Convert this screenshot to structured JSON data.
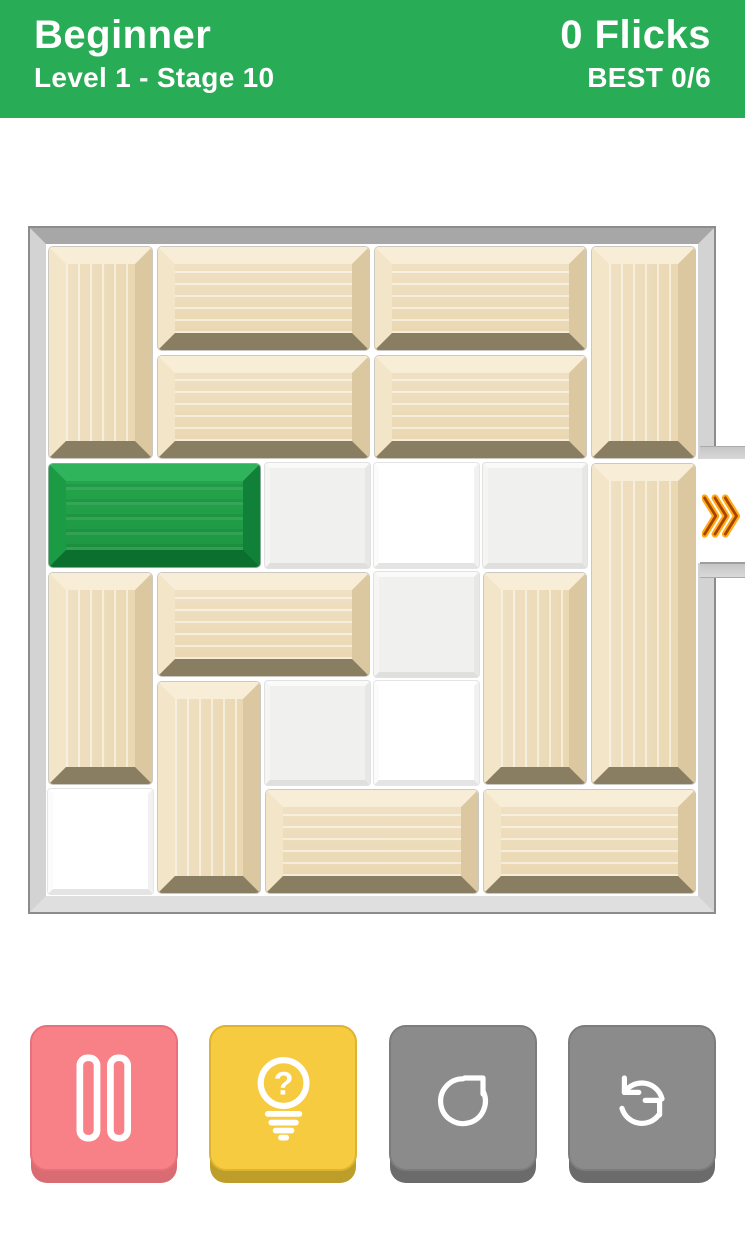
{
  "header": {
    "difficulty": "Beginner",
    "stage": "Level 1 - Stage 10",
    "flicks": "0 Flicks",
    "best": "BEST 0/6",
    "bg": "#28AC55",
    "text_color": "#FFFFFF"
  },
  "board": {
    "rows": 6,
    "cols": 6,
    "frame_color": "#C9C9C9",
    "exit": {
      "side": "right",
      "row": 2,
      "icon": "triple-chevron-right",
      "arrow_glow": "#FFAA16",
      "arrow_core": "#A84300"
    },
    "blocks": [
      {
        "id": "wood-v1",
        "type": "wood",
        "row": 0,
        "col": 0,
        "w": 1,
        "h": 2
      },
      {
        "id": "wood-h1",
        "type": "wood",
        "row": 0,
        "col": 1,
        "w": 2,
        "h": 1
      },
      {
        "id": "wood-h2",
        "type": "wood",
        "row": 0,
        "col": 3,
        "w": 2,
        "h": 1
      },
      {
        "id": "wood-v2",
        "type": "wood",
        "row": 0,
        "col": 5,
        "w": 1,
        "h": 2
      },
      {
        "id": "wood-h3",
        "type": "wood",
        "row": 1,
        "col": 1,
        "w": 2,
        "h": 1
      },
      {
        "id": "wood-h4",
        "type": "wood",
        "row": 1,
        "col": 3,
        "w": 2,
        "h": 1
      },
      {
        "id": "hero",
        "type": "green",
        "row": 2,
        "col": 0,
        "w": 2,
        "h": 1
      },
      {
        "id": "wood-v3",
        "type": "wood",
        "row": 2,
        "col": 5,
        "w": 1,
        "h": 3
      },
      {
        "id": "wood-v4",
        "type": "wood",
        "row": 3,
        "col": 0,
        "w": 1,
        "h": 2
      },
      {
        "id": "wood-h5",
        "type": "wood",
        "row": 3,
        "col": 1,
        "w": 2,
        "h": 1
      },
      {
        "id": "wood-v5",
        "type": "wood",
        "row": 3,
        "col": 4,
        "w": 1,
        "h": 2
      },
      {
        "id": "wood-v6",
        "type": "wood",
        "row": 4,
        "col": 1,
        "w": 1,
        "h": 2
      },
      {
        "id": "wood-h6",
        "type": "wood",
        "row": 5,
        "col": 2,
        "w": 2,
        "h": 1
      },
      {
        "id": "wood-h7",
        "type": "wood",
        "row": 5,
        "col": 4,
        "w": 2,
        "h": 1
      }
    ],
    "empty_cells": [
      {
        "row": 2,
        "col": 2,
        "shade": "gray"
      },
      {
        "row": 2,
        "col": 3,
        "shade": "white"
      },
      {
        "row": 2,
        "col": 4,
        "shade": "gray"
      },
      {
        "row": 3,
        "col": 3,
        "shade": "gray"
      },
      {
        "row": 4,
        "col": 2,
        "shade": "gray"
      },
      {
        "row": 4,
        "col": 3,
        "shade": "white"
      },
      {
        "row": 5,
        "col": 0,
        "shade": "white"
      }
    ],
    "palette": {
      "wood_face": "#ECDAB6",
      "wood_highlight": "#F8EED8",
      "wood_shadow": "#8A7E62",
      "hero_face": "#219C45",
      "hero_shadow": "#0B702D",
      "tile_gray": "#F0F0EF",
      "tile_white": "#FFFFFF"
    }
  },
  "controls": [
    {
      "name": "pause-button",
      "icon": "pause-icon",
      "face": "#F78186",
      "lip": "#D96C72",
      "edge": "#E8707A"
    },
    {
      "name": "hint-button",
      "icon": "hint-lightbulb-icon",
      "face": "#F7CB3F",
      "lip": "#BD9E2B",
      "edge": "#DDB32F"
    },
    {
      "name": "restart-button",
      "icon": "restart-icon",
      "face": "#8B8B8B",
      "lip": "#6B6B6B",
      "edge": "#7C7C7C"
    },
    {
      "name": "shuffle-button",
      "icon": "shuffle-icon",
      "face": "#8B8B8B",
      "lip": "#6B6B6B",
      "edge": "#7C7C7C"
    }
  ]
}
